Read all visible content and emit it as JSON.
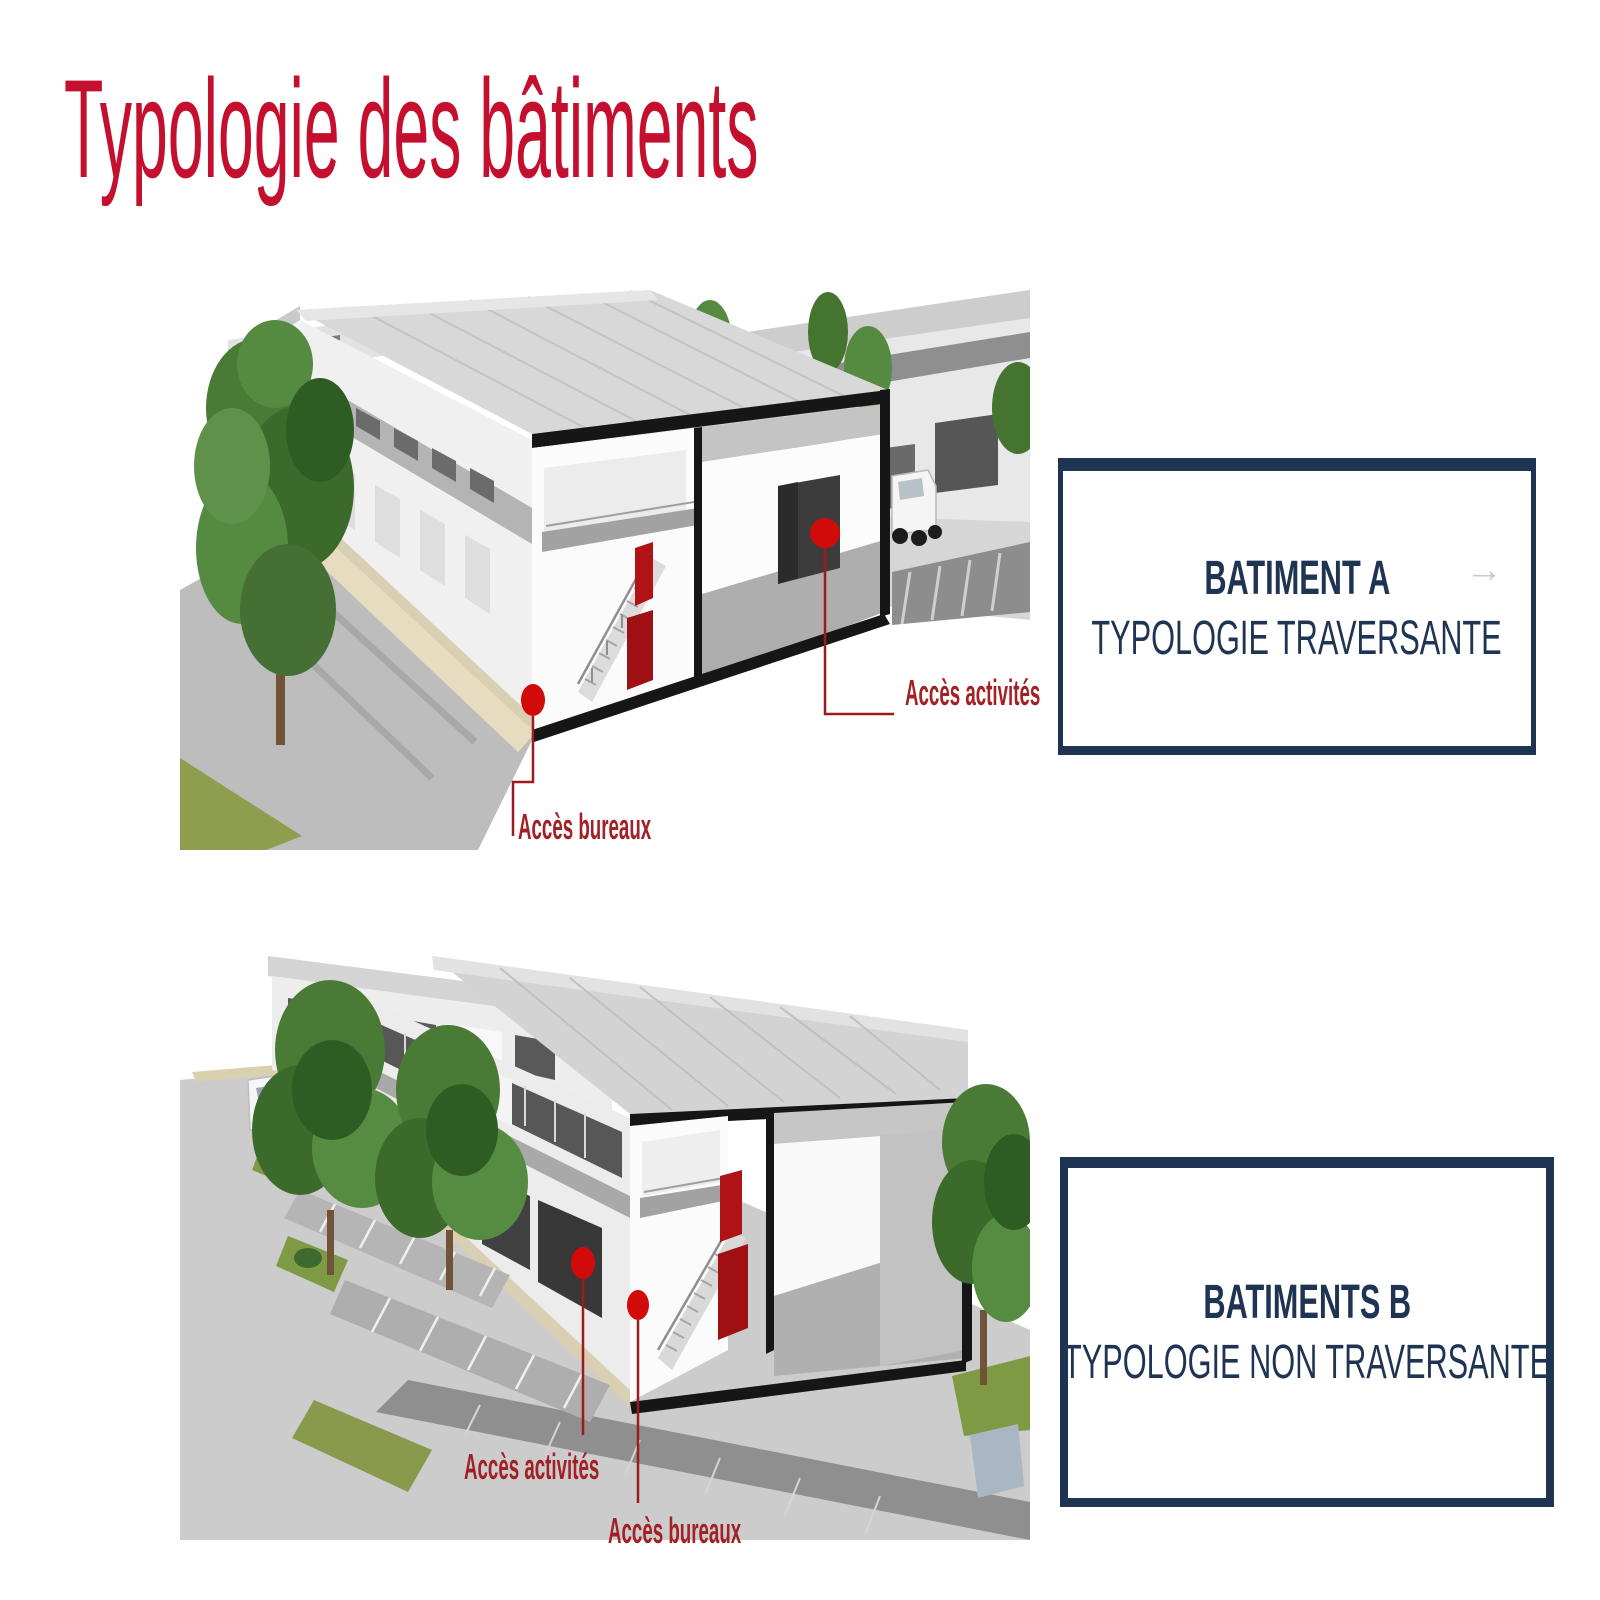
{
  "slide": {
    "title": "Typologie des bâtiments",
    "title_color": "#c40f2e",
    "background": "#ffffff"
  },
  "colors": {
    "navy": "#1e3452",
    "annotation_red": "#a32025",
    "marker_red": "#d20a0a"
  },
  "figures": [
    {
      "caption_line1": "BATIMENT A",
      "caption_line2": "TYPOLOGIE TRAVERSANTE",
      "arrow_icon": "→",
      "annotations": [
        {
          "label": "Accès activités"
        },
        {
          "label": "Accès bureaux"
        }
      ]
    },
    {
      "caption_line1": "BATIMENTS B",
      "caption_line2": "TYPOLOGIE NON TRAVERSANTE",
      "annotations": [
        {
          "label": "Accès activités"
        },
        {
          "label": "Accès bureaux"
        }
      ]
    }
  ]
}
